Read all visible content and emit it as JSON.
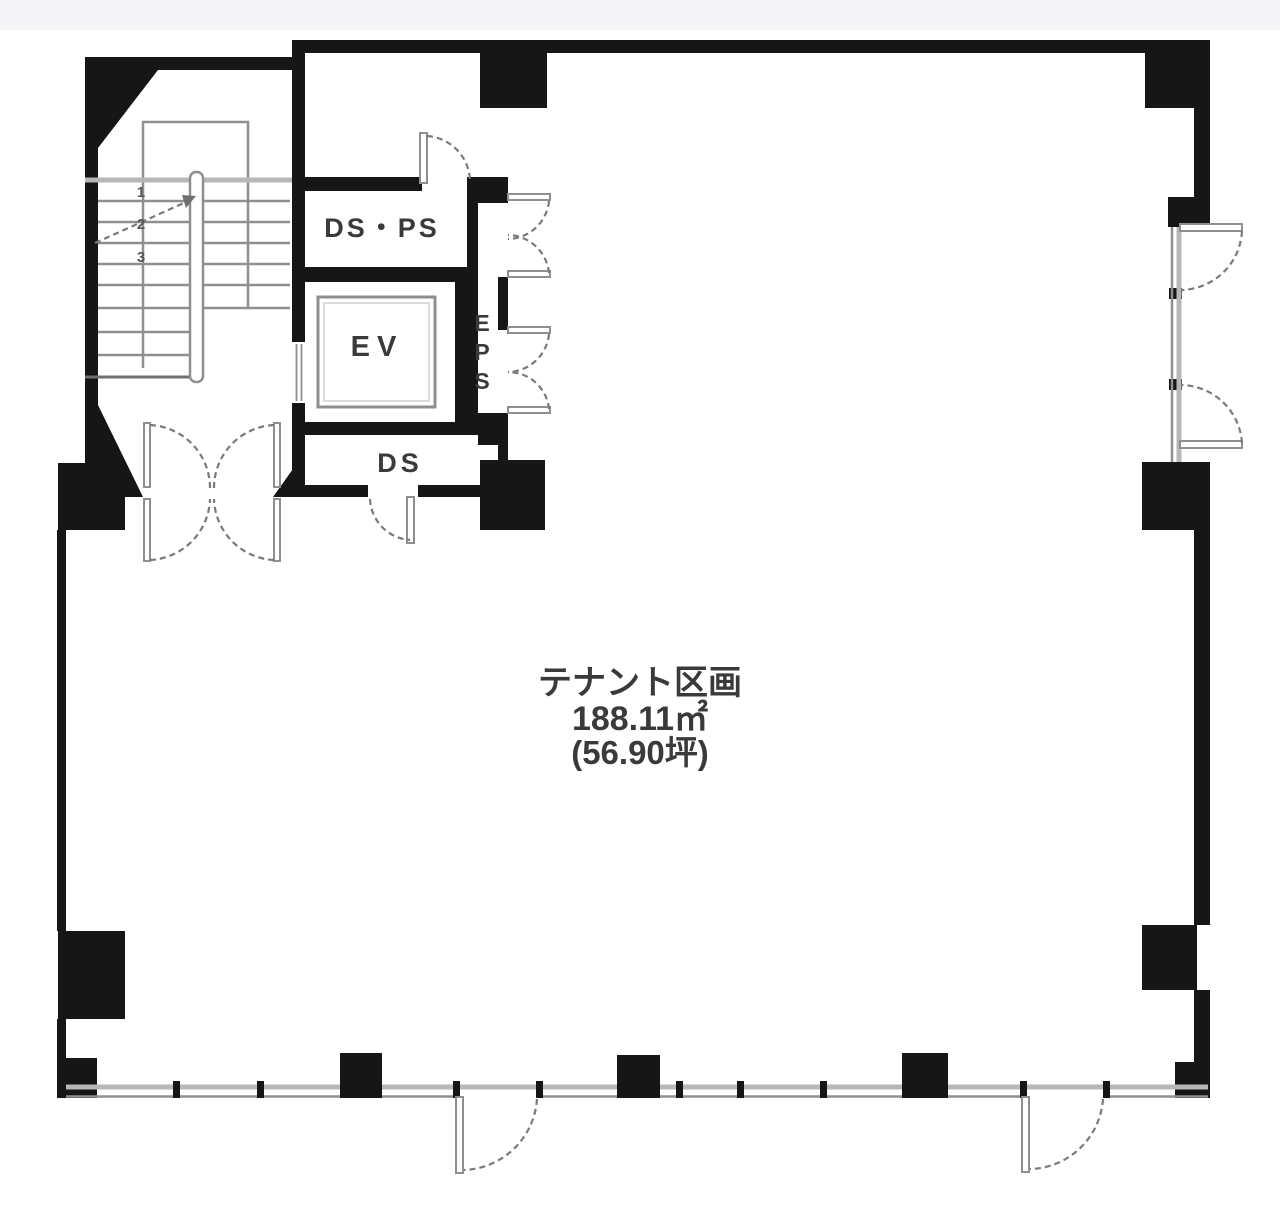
{
  "plan": {
    "rooms": {
      "ds_ps": {
        "label": "DS・PS"
      },
      "ev": {
        "label": "EV"
      },
      "eps": {
        "label": "EPS",
        "letters": [
          "E",
          "P",
          "S"
        ]
      },
      "ds": {
        "label": "DS"
      },
      "tenant": {
        "name": "テナント区画",
        "area_sqm": "188.11㎡",
        "area_tsubo": "(56.90坪)"
      }
    },
    "stairs": {
      "step_marks": [
        "1",
        "2",
        "3"
      ]
    },
    "colors": {
      "wall": "#161616",
      "line": "#8f8f8f",
      "line_light": "#b7b7b7",
      "arc": "#7a7a7a",
      "text": "#3a3a3a",
      "strip": "#f5f5f8"
    }
  }
}
